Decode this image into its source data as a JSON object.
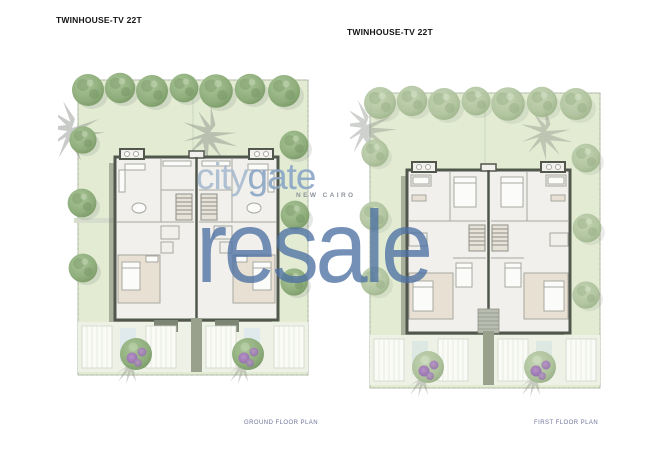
{
  "plans": [
    {
      "title": "TWINHOUSE-TV 22T",
      "caption": "GROUND FLOOR PLAN"
    },
    {
      "title": "TWINHOUSE-TV 22T",
      "caption": "FIRST FLOOR PLAN"
    }
  ],
  "watermark": {
    "brand_left": "city",
    "brand_right": "gate",
    "location": "NEW CAIRO",
    "overlay": "resale",
    "brand_color_left": "#a7bbd0",
    "brand_color_right": "#8aa6c6",
    "overlay_color": "#4d71a3"
  },
  "palette": {
    "sheet_background": "#ffffff",
    "lawn_green": "#e3ecd3",
    "tree_green": "#8fae7c",
    "tree_green_muted": "#b3c5a4",
    "building_wall": "#51574c",
    "building_interior": "#f1f0ec",
    "room_beige": "#e8e0d3",
    "paving": "#eef2e6",
    "shrub_purple": "#9d7fb3",
    "caption_color": "#70749a",
    "title_color": "#141414"
  }
}
